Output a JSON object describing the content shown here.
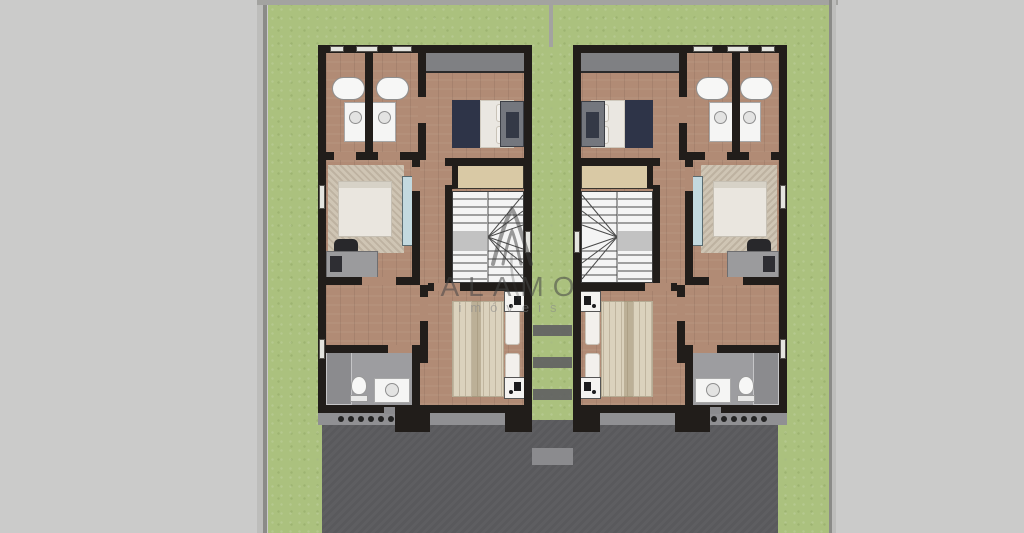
{
  "watermark": {
    "logo": "alamo-monogram-logo",
    "title": "ALAMO",
    "subtitle": "imóveis",
    "title_color": "rgba(70,70,70,0.55)",
    "subtitle_color": "rgba(135,135,135,0.55)"
  },
  "palette": {
    "canvas": "#cbcbca",
    "lawn": "#abc17e",
    "plot_border": "#a3a3a0",
    "wall": "#211d1a",
    "wood_floor": "#b18b75",
    "driveway": "#59595c",
    "walkway": "#909093",
    "balcony": "#7f8083",
    "stairs": "#f4f4f4",
    "stair_landing": "#c2c2c2",
    "closet": "#d9c9a5",
    "wardrobe_glass": "#c3d9df",
    "rug": "#cfc5b4",
    "bed_linen": "#eae7e1",
    "navy_blanket": "#2e3448",
    "master_duvet": "#dbd2bd",
    "bathroom_floor": "#9d9da0",
    "fixture_white": "#f7f7f6"
  },
  "plan": {
    "type": "upper-floor-plan",
    "units": [
      {
        "id": "left-unit",
        "mirrored": false,
        "rooms": [
          "bathroom",
          "bathroom",
          "bedroom",
          "bedroom",
          "stair-hall",
          "master-bedroom",
          "bathroom"
        ]
      },
      {
        "id": "right-unit",
        "mirrored": true,
        "rooms": [
          "bathroom",
          "bathroom",
          "bedroom",
          "bedroom",
          "stair-hall",
          "master-bedroom",
          "bathroom"
        ]
      }
    ]
  }
}
